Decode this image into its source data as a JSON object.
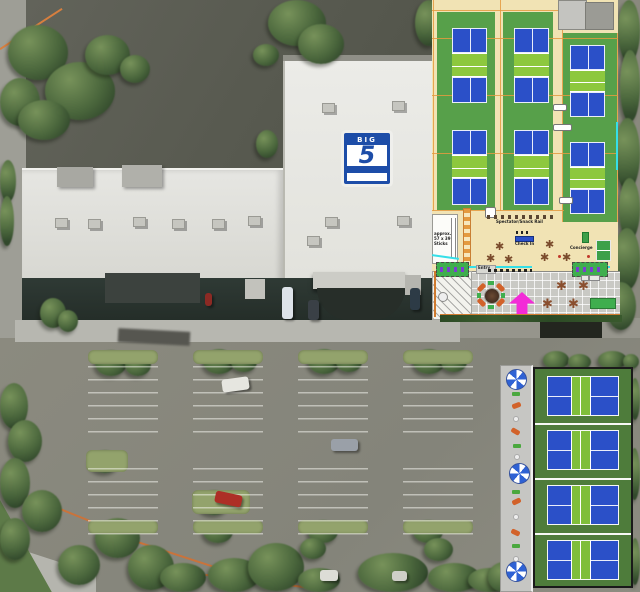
{
  "colors": {
    "court_blue": "#2b50c8",
    "court_green": "#57a04a",
    "kitchen_green": "#8dc83e",
    "outdoor_court_green": "#4e7c3b",
    "outdoor_kitchen_green": "#7fbe3a",
    "floor_beige": "#f1e3b4",
    "grid_orange": "#e49a3f",
    "accent_cyan": "#35dfe8",
    "arrow_magenta": "#f32bd7",
    "logo_blue": "#1d4da8",
    "umbrella_blue": "#2f62d4"
  },
  "building": {
    "logo": {
      "top": "BIG",
      "number": "5",
      "bottom": "SPORTING GOODS"
    }
  },
  "indoor_plan": {
    "court_count": 6,
    "labels": {
      "snack_rail": "Spectator/Snack Rail",
      "check_in": "Check In",
      "concierge": "Concierge",
      "storage_line1": "approx.",
      "storage_line2": "57 x 39",
      "storage_line3": "Sticks",
      "entry": "Entry"
    }
  },
  "outdoor_plan": {
    "court_count": 4
  }
}
